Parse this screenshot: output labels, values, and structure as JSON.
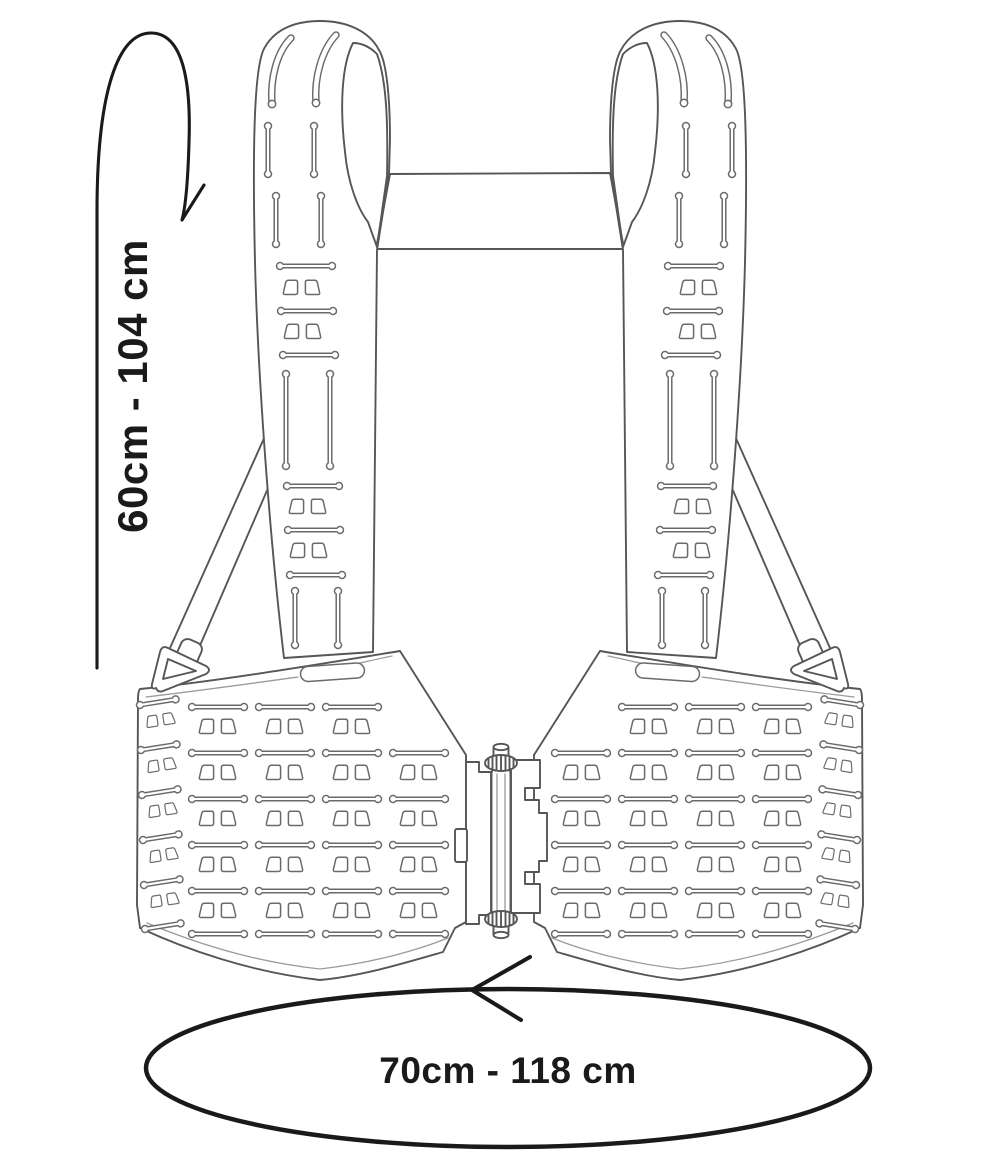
{
  "figure": {
    "kind": "technical line illustration",
    "subject": "adjustable chest rig harness, front view"
  },
  "annotations": {
    "vertical_range_label": "60cm - 104 cm",
    "horizontal_range_label": "70cm - 118 cm"
  },
  "icons": {
    "vertical_arrow": "curved-hook-arrow",
    "horizontal_arrow": "chevron-left-arrow",
    "range_marker": "ellipse-outline"
  },
  "colors": {
    "background": "#ffffff",
    "line": "#565656",
    "line_light": "#9b9b9b",
    "annotation": "#1a1a1a"
  }
}
